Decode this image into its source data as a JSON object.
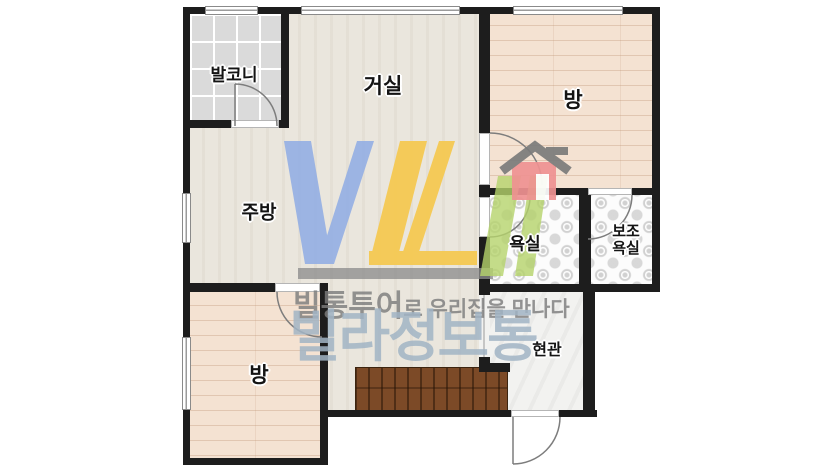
{
  "rooms": {
    "balcony": {
      "label": "발코니"
    },
    "living_room": {
      "label": "거실"
    },
    "bedroom_top_right": {
      "label": "방"
    },
    "kitchen": {
      "label": "주방"
    },
    "bathroom": {
      "label": "욕실"
    },
    "aux_bathroom": {
      "line1": "보조",
      "line2": "욕실"
    },
    "entrance": {
      "label": "현관"
    },
    "bedroom_bottom_left": {
      "label": "방"
    }
  },
  "watermark": {
    "tagline_bold": "빌통투어",
    "tagline_rest": "로 우리집을 만나다",
    "brand": "빌라정보통",
    "house_icon": "house-icon",
    "colors": {
      "logo_blue": "#94afe4",
      "logo_yellow": "#f6c84b",
      "logo_green": "#b5d36b",
      "logo_gray": "#8c8c8c",
      "brand_text": "#b3c2cf",
      "house_body": "#ef9292",
      "house_roof": "#7b7b7b",
      "wall": "#1d1d1d"
    }
  }
}
